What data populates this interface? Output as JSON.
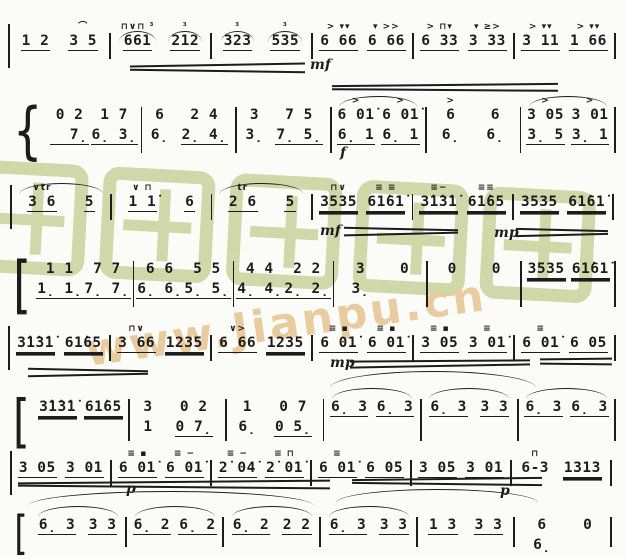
{
  "watermark": {
    "chars": "歌谱简谱网",
    "url_text": "www.Jianpu.cn",
    "green": "#ccd5a2",
    "orange": "#e9cba0"
  },
  "score": {
    "ink": "#1c1c1c",
    "systems": [
      {
        "top": 22,
        "left": 8,
        "width": 608,
        "bracket": "|",
        "blh": 26,
        "bars": [
          {
            "cells": [
              {
                "t": "1 2",
                "u": 1
              },
              {
                "t": "3 5",
                "u": 1,
                "a": "⌒"
              }
            ]
          },
          {
            "cells": [
              {
                "t": "661",
                "u": 1,
                "a": "⊓∨⊓ ³",
                "arc": true
              },
              {
                "t": "212",
                "u": 1,
                "a": "³",
                "arc": true
              }
            ]
          },
          {
            "cells": [
              {
                "t": "323",
                "u": 1,
                "a": "³",
                "arc": true
              },
              {
                "t": "535",
                "u": 1,
                "a": "³",
                "arc": true
              }
            ]
          },
          {
            "cells": [
              {
                "t": "6 66",
                "u": 1,
                "a": "> ▾▾"
              },
              {
                "t": "6 66",
                "u": 1,
                "a": "▾ >>"
              }
            ]
          },
          {
            "cells": [
              {
                "t": "6 33",
                "u": 1,
                "a": "> ⊓▾"
              },
              {
                "t": "3 33",
                "u": 1,
                "a": "▾ ≥>"
              }
            ]
          },
          {
            "cells": [
              {
                "t": "3 11",
                "u": 1,
                "a": "> ▾▾"
              },
              {
                "t": "1 66",
                "u": 1,
                "a": "> ▾▾"
              }
            ]
          }
        ]
      },
      {
        "top": 96,
        "left": 8,
        "width": 608,
        "bracket": "{",
        "blh": 46,
        "bars": [
          {
            "cells": [
              {
                "t": "0 2",
                "b": "  7̣",
                "bu": 1
              },
              {
                "t": "1 7",
                "b": "6̣ 3̣",
                "bu": 1
              }
            ]
          },
          {
            "cells": [
              {
                "t": "6",
                "b": "6̣"
              },
              {
                "t": "2 4",
                "b": "2̣ 4̣",
                "bu": 1
              }
            ]
          },
          {
            "cells": [
              {
                "t": "3",
                "b": "3̣"
              },
              {
                "t": "7 5",
                "b": "7̣ 5̣",
                "bu": 1
              }
            ]
          },
          {
            "arc": true,
            "cells": [
              {
                "t": "6 01̇",
                "b": "6̣ 1",
                "bu": 1,
                "a": ">"
              },
              {
                "t": "6 01̇",
                "b": "6̣ 1",
                "bu": 1,
                "a": ">"
              }
            ]
          },
          {
            "cells": [
              {
                "t": "6",
                "b": "6̣",
                "a": ">"
              },
              {
                "t": "6",
                "b": "6̣"
              }
            ]
          },
          {
            "arc": true,
            "cells": [
              {
                "t": "3 05",
                "b": "3̣ 5",
                "bu": 1,
                "a": ">"
              },
              {
                "t": "3 01",
                "b": "3̣ 1",
                "bu": 1,
                "a": ">"
              }
            ]
          }
        ]
      },
      {
        "top": 183,
        "left": 10,
        "width": 604,
        "bracket": "|",
        "blh": 26,
        "bars": [
          {
            "arc": true,
            "cells": [
              {
                "t": "3 6",
                "u": 1,
                "a": "∨tr"
              },
              {
                "t": "5",
                "u": 1
              }
            ]
          },
          {
            "cells": [
              {
                "t": "1 1̇",
                "u": 1,
                "a": "∨ ⊓"
              },
              {
                "t": "6",
                "u": 1
              }
            ]
          },
          {
            "arc": true,
            "cells": [
              {
                "t": "2 6",
                "u": 1,
                "a": "tr"
              },
              {
                "t": "5",
                "u": 1
              }
            ]
          },
          {
            "cells": [
              {
                "t": "3535",
                "u": 2,
                "a": "⊓∨"
              },
              {
                "t": "61̇61̇",
                "u": 2,
                "a": "≡ ≡"
              }
            ]
          },
          {
            "cells": [
              {
                "t": "3̇1̇3̇1̇",
                "u": 2,
                "a": "≡−"
              },
              {
                "t": "61̇65",
                "u": 2,
                "a": "≡≡"
              }
            ]
          },
          {
            "cells": [
              {
                "t": "3535",
                "u": 2
              },
              {
                "t": "61̇61̇",
                "u": 2
              }
            ]
          }
        ]
      },
      {
        "top": 250,
        "left": 10,
        "width": 606,
        "bracket": "[",
        "blh": 46,
        "bars": [
          {
            "cells": [
              {
                "t": "1 1",
                "b": "1̣ 1̣",
                "bu": 1
              },
              {
                "t": "7 7",
                "b": "7̣ 7̣",
                "bu": 1
              }
            ]
          },
          {
            "cells": [
              {
                "t": "6 6",
                "b": "6̣ 6̣",
                "bu": 1
              },
              {
                "t": "5 5",
                "b": "5̣ 5̣",
                "bu": 1
              }
            ]
          },
          {
            "cells": [
              {
                "t": "4 4",
                "b": "4̣ 4̣",
                "bu": 1
              },
              {
                "t": "2 2",
                "b": "2̣ 2̣",
                "bu": 1
              }
            ]
          },
          {
            "cells": [
              {
                "t": "3",
                "b": "3̣"
              },
              {
                "t": "0"
              }
            ]
          },
          {
            "cells": [
              {
                "t": "0"
              },
              {
                "t": "0"
              }
            ]
          },
          {
            "cells": [
              {
                "t": "3535",
                "u": 2
              },
              {
                "t": "61̇61̇",
                "u": 2
              }
            ]
          }
        ]
      },
      {
        "top": 324,
        "left": 8,
        "width": 608,
        "bracket": "|",
        "blh": 26,
        "bars": [
          {
            "cells": [
              {
                "t": "3̇1̇3̇1̇",
                "u": 2
              },
              {
                "t": "61̇65",
                "u": 2
              }
            ]
          },
          {
            "cells": [
              {
                "t": "3 66",
                "u": 1,
                "a": "⊓∨"
              },
              {
                "t": "1235",
                "u": 2
              }
            ]
          },
          {
            "cells": [
              {
                "t": "6 66",
                "u": 1,
                "a": "∨>"
              },
              {
                "t": "1235",
                "u": 2
              }
            ]
          },
          {
            "cells": [
              {
                "t": "6 01̇",
                "u": 1,
                "a": "≡ ▪"
              },
              {
                "t": "6 01̇",
                "u": 1,
                "a": "≡ ▪"
              }
            ]
          },
          {
            "cells": [
              {
                "t": "3 05",
                "u": 1,
                "a": "≡ ▪"
              },
              {
                "t": "3 01̇",
                "u": 1,
                "a": "≡"
              }
            ]
          },
          {
            "cells": [
              {
                "t": "6 01̇",
                "u": 1,
                "a": "≡"
              },
              {
                "t": "6 05",
                "u": 1
              }
            ]
          }
        ]
      },
      {
        "top": 388,
        "left": 10,
        "width": 606,
        "bracket": "[",
        "blh": 42,
        "bars": [
          {
            "cells": [
              {
                "t": "3̇1̇3̇1̇",
                "u": 2
              },
              {
                "t": "61̇65",
                "u": 2
              }
            ]
          },
          {
            "cells": [
              {
                "t": "3",
                "b": "1"
              },
              {
                "t": "0 2",
                "b": "0 7̣",
                "bu": 1
              }
            ]
          },
          {
            "cells": [
              {
                "t": "1",
                "b": "6̣"
              },
              {
                "t": "0 7",
                "b": "0 5̣",
                "bu": 1
              }
            ]
          },
          {
            "arc": true,
            "cells": [
              {
                "t": "6̣ 3",
                "u": 1
              },
              {
                "t": "6̣ 3",
                "u": 1
              }
            ]
          },
          {
            "arc": true,
            "cells": [
              {
                "t": "6̣ 3",
                "u": 1
              },
              {
                "t": "3 3",
                "u": 1
              }
            ]
          },
          {
            "arc": true,
            "cells": [
              {
                "t": "6̣ 3",
                "u": 1
              },
              {
                "t": "6̣ 3",
                "u": 1
              }
            ]
          }
        ]
      },
      {
        "top": 449,
        "left": 10,
        "width": 602,
        "bracket": "|",
        "blh": 26,
        "bars": [
          {
            "cells": [
              {
                "t": "3 05",
                "u": 1
              },
              {
                "t": "3 01",
                "u": 1
              }
            ]
          },
          {
            "cells": [
              {
                "t": "6 01̇",
                "u": 1,
                "a": "≡ ▪"
              },
              {
                "t": "6 01̇",
                "u": 1,
                "a": "≡ −"
              }
            ]
          },
          {
            "cells": [
              {
                "t": "2̇ 04̇",
                "u": 1,
                "a": "≡ −"
              },
              {
                "t": "2̇ 01̇",
                "u": 1,
                "a": "≡ ⊓"
              }
            ]
          },
          {
            "cells": [
              {
                "t": "6 01̇",
                "u": 1,
                "a": "≡"
              },
              {
                "t": "6 05",
                "u": 1
              }
            ]
          },
          {
            "cells": [
              {
                "t": "3 05",
                "u": 1
              },
              {
                "t": "3 01",
                "u": 1
              }
            ]
          },
          {
            "cells": [
              {
                "t": "6-3",
                "a": "⊓"
              },
              {
                "t": "1313",
                "u": 2
              }
            ]
          }
        ]
      },
      {
        "top": 506,
        "left": 12,
        "width": 600,
        "bracket": "[",
        "blh": 30,
        "bars": [
          {
            "arc": true,
            "cells": [
              {
                "t": "6̣ 3",
                "u": 1
              },
              {
                "t": "3 3",
                "u": 1
              }
            ]
          },
          {
            "arc": true,
            "cells": [
              {
                "t": "6̣ 2",
                "u": 1
              },
              {
                "t": "6̣ 2",
                "u": 1
              }
            ]
          },
          {
            "arc": true,
            "cells": [
              {
                "t": "6̣ 2",
                "u": 1
              },
              {
                "t": "2 2",
                "u": 1
              }
            ]
          },
          {
            "arc": true,
            "cells": [
              {
                "t": "6̣ 3",
                "u": 1
              },
              {
                "t": "3 3",
                "u": 1
              }
            ]
          },
          {
            "cells": [
              {
                "t": "1 3",
                "u": 1
              },
              {
                "t": "3 3",
                "u": 1
              }
            ]
          },
          {
            "cells": [
              {
                "t": "6",
                "b": "6̣"
              },
              {
                "t": "0"
              }
            ]
          }
        ]
      }
    ],
    "dynamics": [
      {
        "t": "mf",
        "x": 310,
        "y": 58
      },
      {
        "t": "f",
        "x": 340,
        "y": 146
      },
      {
        "t": "mf",
        "x": 320,
        "y": 224
      },
      {
        "t": "mp",
        "x": 494,
        "y": 226
      },
      {
        "t": "mp",
        "x": 330,
        "y": 356
      },
      {
        "t": "p",
        "x": 126,
        "y": 482
      },
      {
        "t": "p",
        "x": 500,
        "y": 484
      }
    ],
    "deco_lines": [
      {
        "x": 130,
        "y": 64,
        "w": 175,
        "r": -1
      },
      {
        "x": 130,
        "y": 70,
        "w": 175,
        "r": 0.8
      },
      {
        "x": 332,
        "y": 84,
        "w": 226,
        "r": -0.6
      },
      {
        "x": 332,
        "y": 89,
        "w": 226,
        "r": 0.4
      },
      {
        "x": 344,
        "y": 228,
        "w": 114,
        "r": 1.2
      },
      {
        "x": 344,
        "y": 233,
        "w": 114,
        "r": -1.4
      },
      {
        "x": 516,
        "y": 229,
        "w": 92,
        "r": 1.4
      },
      {
        "x": 516,
        "y": 234,
        "w": 92,
        "r": -1.4
      },
      {
        "x": 28,
        "y": 369,
        "w": 120,
        "r": 1.2
      },
      {
        "x": 28,
        "y": 374,
        "w": 120,
        "r": -1.2
      },
      {
        "x": 350,
        "y": 360,
        "w": 180,
        "r": -0.4
      },
      {
        "x": 350,
        "y": 365,
        "w": 180,
        "r": -1
      },
      {
        "x": 540,
        "y": 358,
        "w": 72,
        "r": -0.6
      },
      {
        "x": 540,
        "y": 363,
        "w": 72,
        "r": 0.6
      },
      {
        "x": 18,
        "y": 481,
        "w": 312,
        "r": -0.5
      },
      {
        "x": 18,
        "y": 486,
        "w": 312,
        "r": 0.5
      },
      {
        "x": 352,
        "y": 478,
        "w": 190,
        "r": -0.7
      },
      {
        "x": 352,
        "y": 483,
        "w": 190,
        "r": 0.7
      }
    ],
    "deco_arcs": [
      {
        "x": 330,
        "y": 371,
        "w": 206,
        "h": 16
      },
      {
        "x": 28,
        "y": 491,
        "w": 286,
        "h": 14
      },
      {
        "x": 336,
        "y": 489,
        "w": 202,
        "h": 13
      }
    ]
  }
}
